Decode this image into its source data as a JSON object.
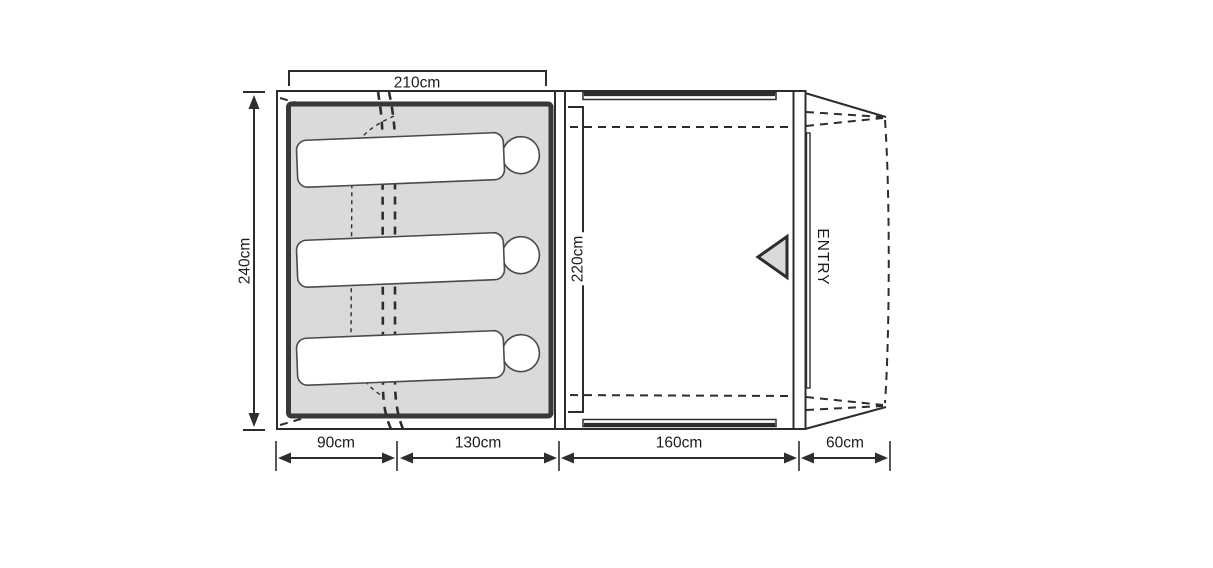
{
  "diagram": {
    "type": "tent-floorplan-top-view",
    "labels": {
      "top_width": "210cm",
      "side_depth": "240cm",
      "inner_depth": "220cm",
      "entry": "ENTRY",
      "bottom": [
        "90cm",
        "130cm",
        "160cm",
        "60cm"
      ]
    },
    "measurements_cm": {
      "sleeping_area_width": 210,
      "tent_depth": 240,
      "living_area_depth": 220,
      "bottom_segments": [
        90,
        130,
        160,
        60
      ]
    },
    "areas": [
      {
        "name": "sleeping-area",
        "occupants": 3
      },
      {
        "name": "living-area"
      },
      {
        "name": "entry-porch"
      }
    ],
    "colors": {
      "line": "#2d2d2d",
      "inner_tent_border": "#383838",
      "sleeping_fill": "#dadada",
      "marker_fill": "#d9d9d9",
      "background": "#ffffff"
    }
  }
}
